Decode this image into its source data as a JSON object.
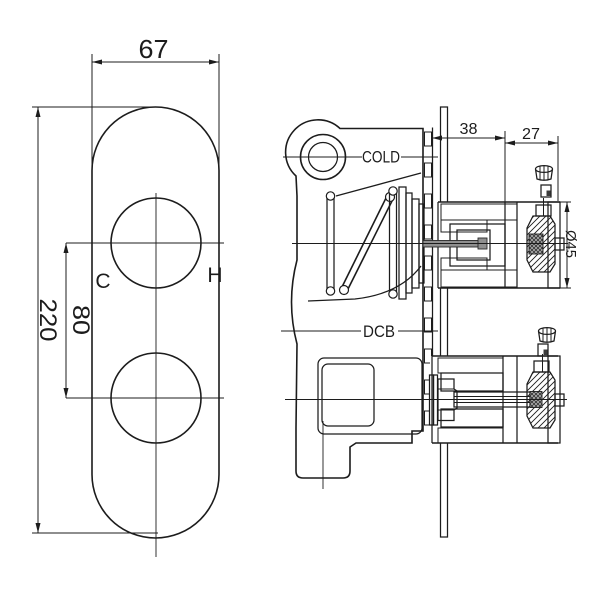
{
  "drawing": {
    "front_view": {
      "dim_plate_width": "67",
      "dim_plate_height": "220",
      "dim_handle_spacing": "80",
      "label_cold_handle": "C",
      "label_hot_handle": "H"
    },
    "side_view": {
      "label_cold_inlet": "COLD",
      "label_dcb": "DCB",
      "dim_rough_in_depth": "38",
      "dim_trim_depth": "27",
      "dim_handle_diameter": "Ø45"
    },
    "colors": {
      "line": "#1c1c1c",
      "background": "#ffffff"
    }
  }
}
